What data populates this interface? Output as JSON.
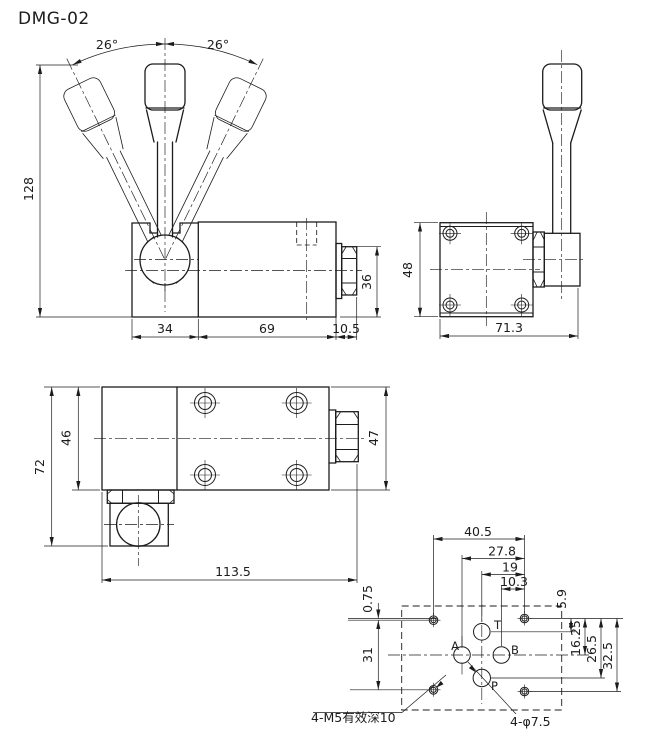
{
  "title": "DMG-02",
  "front_view": {
    "angle_left": "26°",
    "angle_right": "26°",
    "overall_height": "128",
    "block_width": "34",
    "body_width": "69",
    "end_cap_width": "10.5",
    "end_cap_height": "36"
  },
  "side_view": {
    "body_height": "48",
    "overall_width": "71.3"
  },
  "top_view": {
    "overall_height": "72",
    "body_height": "46",
    "end_height": "47",
    "overall_width": "113.5"
  },
  "port_view": {
    "mount_span_h": "40.5",
    "dim_a_to_mount": "27.8",
    "dim_pt_to_mount": "19",
    "dim_b_to_mount": "10.3",
    "mount_offset": "0.75",
    "mount_span_left": "31",
    "dim_t_v": "5.9",
    "dim_ab_v": "16.25",
    "dim_p_v": "26.5",
    "mount_span_right": "32.5",
    "port_a": "A",
    "port_b": "B",
    "port_p": "P",
    "port_t": "T",
    "note_mount": "4-M5有效深10",
    "note_ports": "4-φ7.5"
  }
}
